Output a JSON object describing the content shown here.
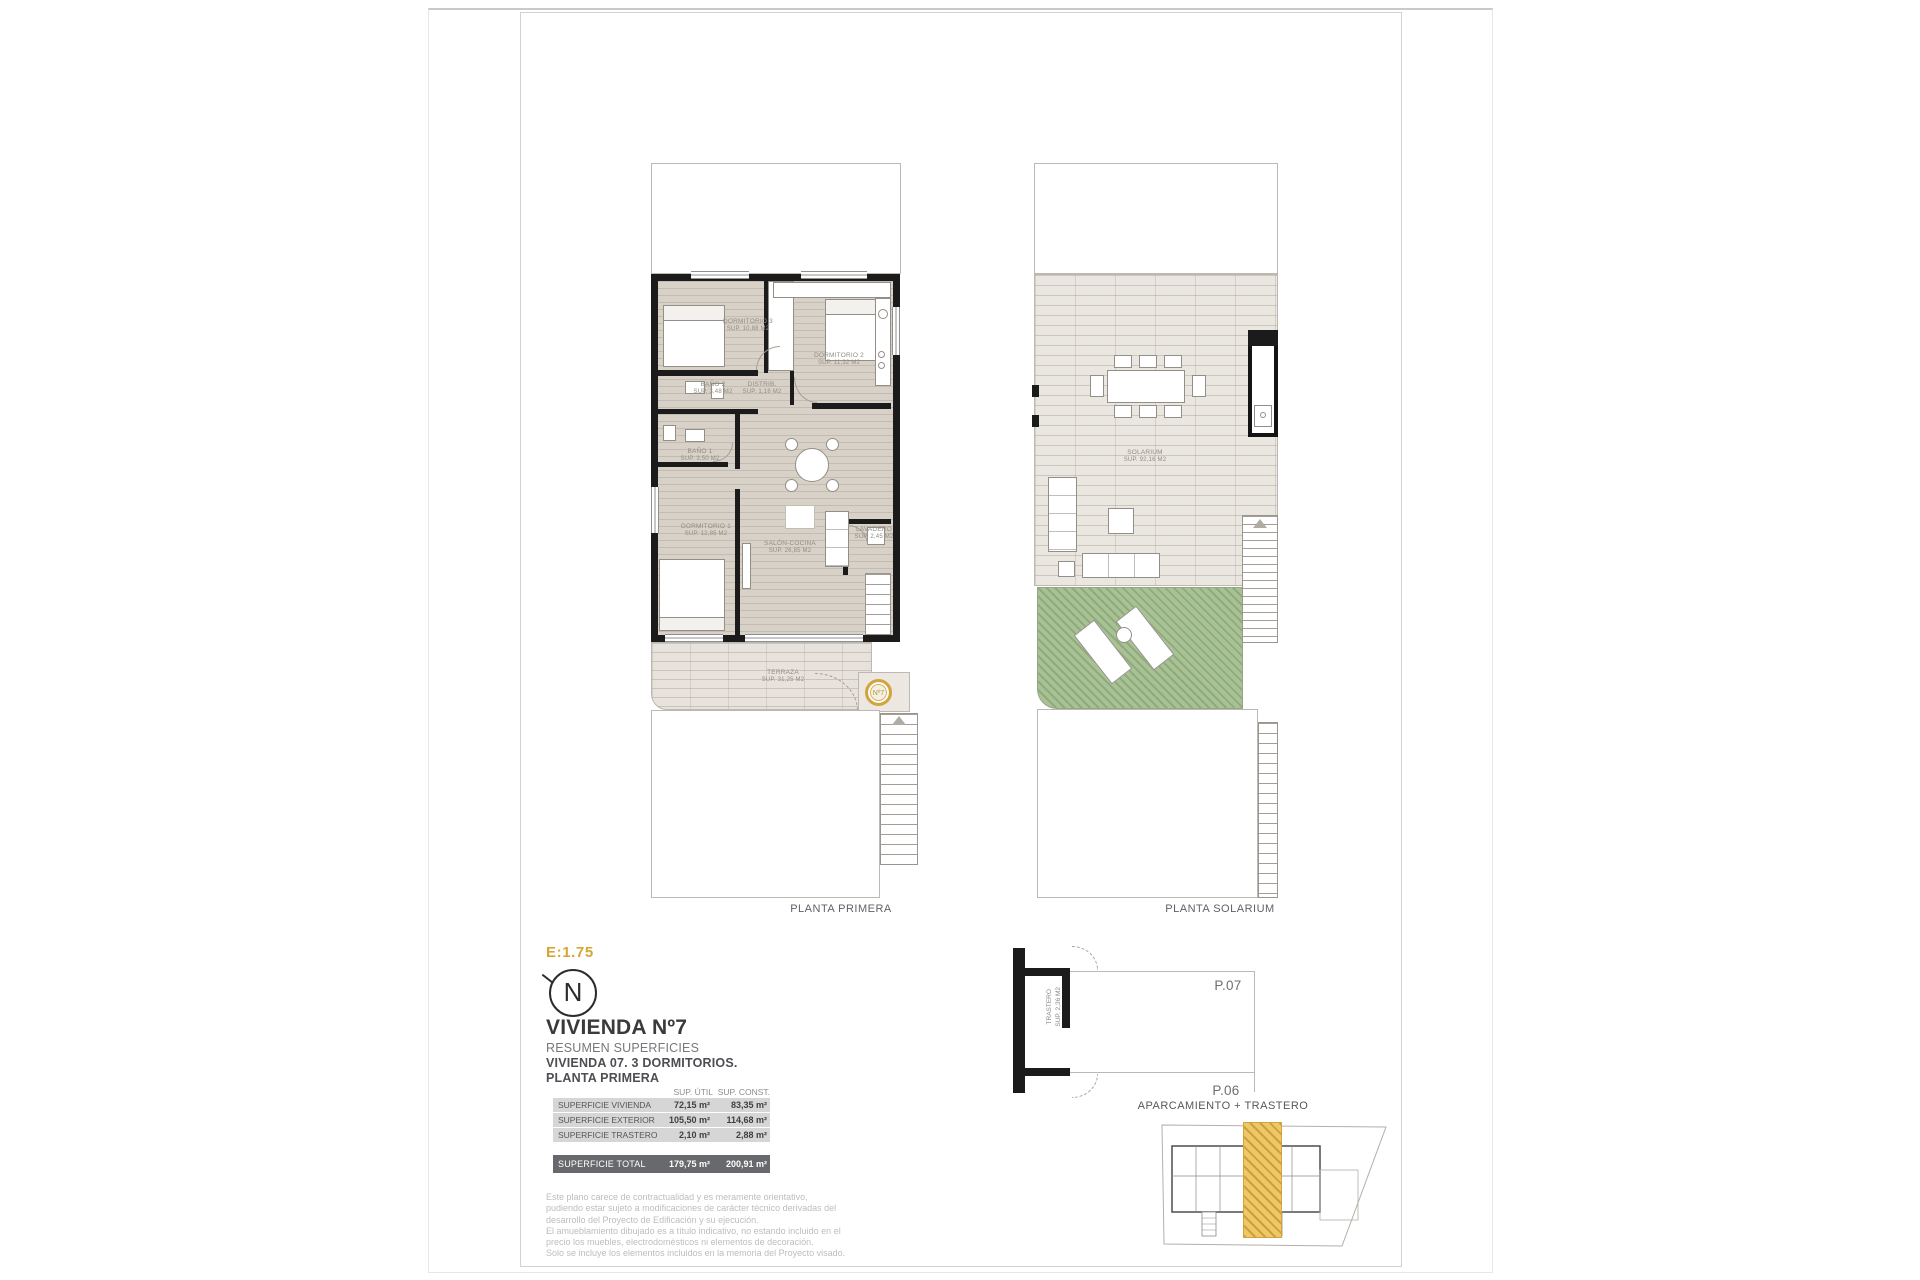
{
  "sheet": {
    "scale": "E:1.75",
    "north": "N"
  },
  "plans": {
    "primera": {
      "caption": "PLANTA PRIMERA",
      "badge": "Nº7",
      "rooms": {
        "dormitorio3": {
          "name": "DORMITORIO 3",
          "sup": "SUP. 10,88 M2"
        },
        "dormitorio2": {
          "name": "DORMITORIO 2",
          "sup": "SUP. 11,32 M2"
        },
        "bano2": {
          "name": "BAÑO 2",
          "sup": "SUP. 3,48 M2"
        },
        "distribuidor": {
          "name": "DISTRIB.",
          "sup": "SUP. 1,16 M2"
        },
        "bano1": {
          "name": "BAÑO 1",
          "sup": "SUP. 3,50 M2"
        },
        "dormitorio1": {
          "name": "DORMITORIO 1",
          "sup": "SUP. 12,85 M2"
        },
        "salon": {
          "name": "SALÓN-COCINA",
          "sup": "SUP. 26,85 M2"
        },
        "lavadero": {
          "name": "LAVADERO",
          "sup": "SUP. 2,45 M2"
        },
        "terraza": {
          "name": "TERRAZA",
          "sup": "SUP. 31,25 M2"
        }
      }
    },
    "solarium": {
      "caption": "PLANTA SOLARIUM",
      "rooms": {
        "solarium": {
          "name": "SOLARIUM",
          "sup": "SUP. 92,16 M2"
        }
      }
    }
  },
  "title_block": {
    "title": "VIVIENDA Nº7",
    "subtitle1": "RESUMEN SUPERFICIES",
    "subtitle2": "VIVIENDA 07. 3 DORMITORIOS.",
    "subtitle3": "PLANTA PRIMERA"
  },
  "surfaces_table": {
    "headers": {
      "util": "SUP. ÚTIL",
      "const": "SUP. CONST."
    },
    "rows": [
      {
        "label": "SUPERFICIE VIVIENDA",
        "util": "72,15 m²",
        "const": "83,35 m²"
      },
      {
        "label": "SUPERFICIE EXTERIOR",
        "util": "105,50 m²",
        "const": "114,68 m²"
      },
      {
        "label": "SUPERFICIE TRASTERO",
        "util": "2,10 m²",
        "const": "2,88 m²"
      }
    ],
    "total": {
      "label": "SUPERFICIE TOTAL",
      "util": "179,75 m²",
      "const": "200,91 m²"
    }
  },
  "disclaimer": {
    "p1": "Este plano carece de contractualidad y es meramente orientativo, pudiendo estar sujeto a modificaciones de carácter técnico derivadas del desarrollo del Proyecto de Edificación y su ejecución.",
    "p2": "El amueblamiento dibujado es a título indicativo, no estando incluido en el precio los muebles, electrodomésticos ni elementos de decoración.",
    "p3": "Solo se incluye los elementos incluidos en la memoria del Proyecto visado."
  },
  "parking": {
    "caption": "APARCAMIENTO + TRASTERO",
    "trastero_name": "TRASTERO",
    "trastero_sup": "SUP. 2,36 M2",
    "stall_top": "P.07",
    "stall_bottom": "P.06"
  },
  "colors": {
    "accent_gold": "#d2a43c",
    "wall": "#1b1b1b",
    "grass": "#a9c295",
    "total_row": "#68696c"
  }
}
